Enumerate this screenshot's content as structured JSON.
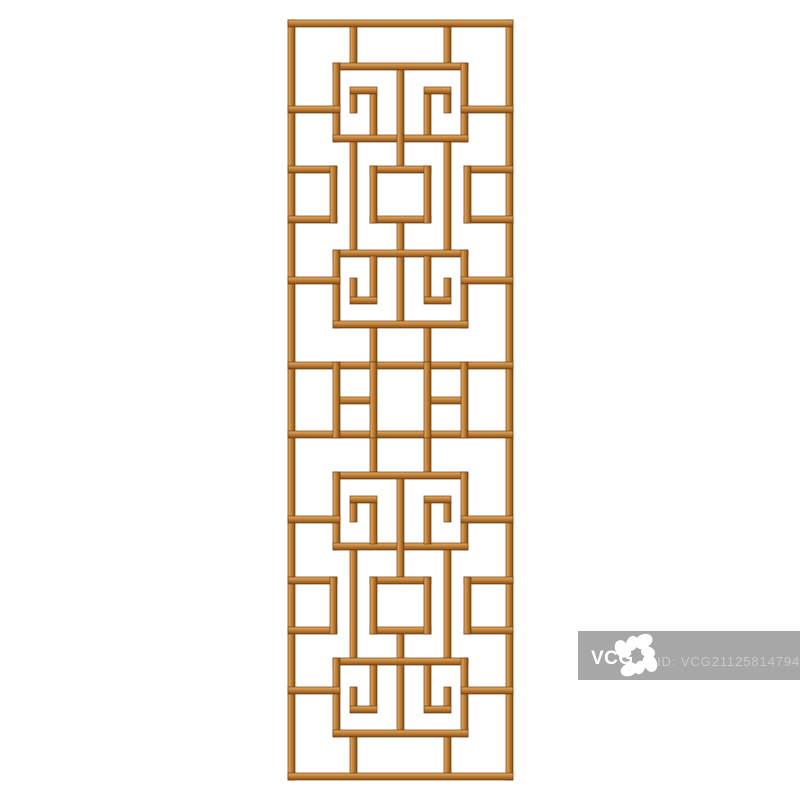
{
  "canvas": {
    "background_color": "#ffffff"
  },
  "lattice_panel": {
    "wood_color_light": "#e3ae67",
    "wood_color_mid": "#c07e35",
    "wood_color_dark": "#965d20",
    "wood_color_edge": "#6f3e13"
  },
  "watermark": {
    "logo_text": "VCG",
    "id_text": "ID: VCG211258147949",
    "box_color": "#a7a7a7",
    "logo_color": "#ffffff",
    "id_text_color": "#c9c9c9"
  }
}
